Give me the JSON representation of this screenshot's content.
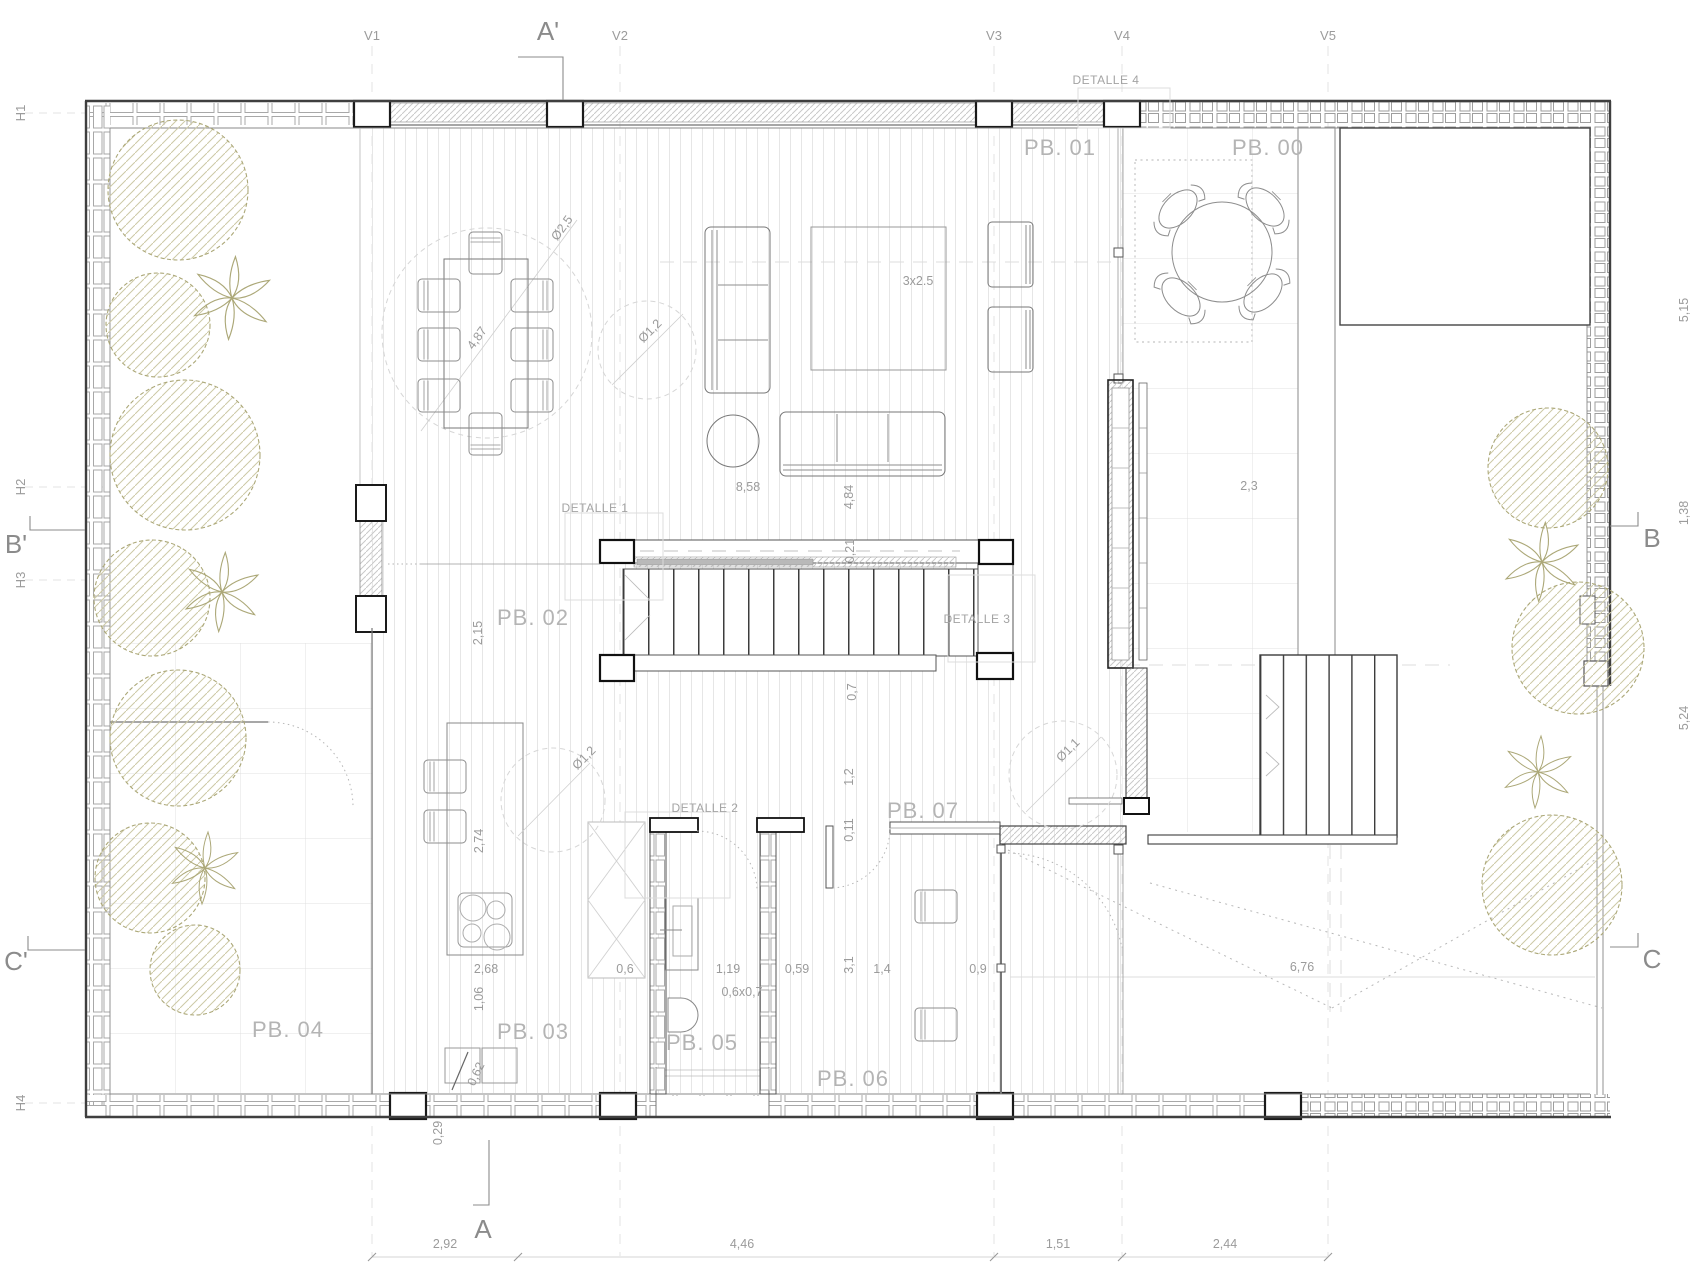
{
  "rooms": {
    "pb00": "PB. 00",
    "pb01": "PB. 01",
    "pb02": "PB. 02",
    "pb03": "PB. 03",
    "pb04": "PB. 04",
    "pb05": "PB. 05",
    "pb06": "PB. 06",
    "pb07": "PB. 07"
  },
  "details": {
    "d1": "DETALLE 1",
    "d2": "DETALLE 2",
    "d3": "DETALLE 3",
    "d4": "DETALLE 4"
  },
  "grid": {
    "v1": "V1",
    "v2": "V2",
    "v3": "V3",
    "v4": "V4",
    "v5": "V5",
    "h1": "H1",
    "h2": "H2",
    "h3": "H3",
    "h4": "H4",
    "a_prime": "A'",
    "a": "A",
    "b_prime": "B'",
    "b": "B",
    "c_prime": "C'",
    "c": "C"
  },
  "dims": {
    "right_top": "5,15",
    "right_mid": "1,38",
    "right_bottom": "5,24",
    "bottom_1": "2,92",
    "bottom_2": "4,46",
    "bottom_3": "1,51",
    "bottom_4": "2,44",
    "dining_circle": "Ø2,5",
    "dining_diag": "4,87",
    "living_circle": "Ø1,2",
    "rug": "3x2.5",
    "living_width": "8,58",
    "living_depth": "4,84",
    "stair_nosing": "0,21",
    "stair_width": "0,7",
    "pb02_width": "2,15",
    "kitchen_circle": "Ø1,2",
    "island_length": "2,74",
    "island_width": "2,68",
    "k_106": "1,06",
    "k_062": "0,62",
    "k_029": "0,29",
    "bath_06": "0,6",
    "bath_119": "1,19",
    "bath_059": "0,59",
    "shower": "0,6x0,7",
    "hall_31": "3,1",
    "hall_14": "1,4",
    "hall_011": "0,11",
    "hall_12": "1,2",
    "hall_09": "0,9",
    "porch_circle": "Ø1,1",
    "terrace_23": "2,3",
    "terrace_676": "6,76"
  },
  "colors": {
    "ink": "#3f3f3f",
    "line_light": "#9b9b9b",
    "foliage": "#aca878"
  }
}
